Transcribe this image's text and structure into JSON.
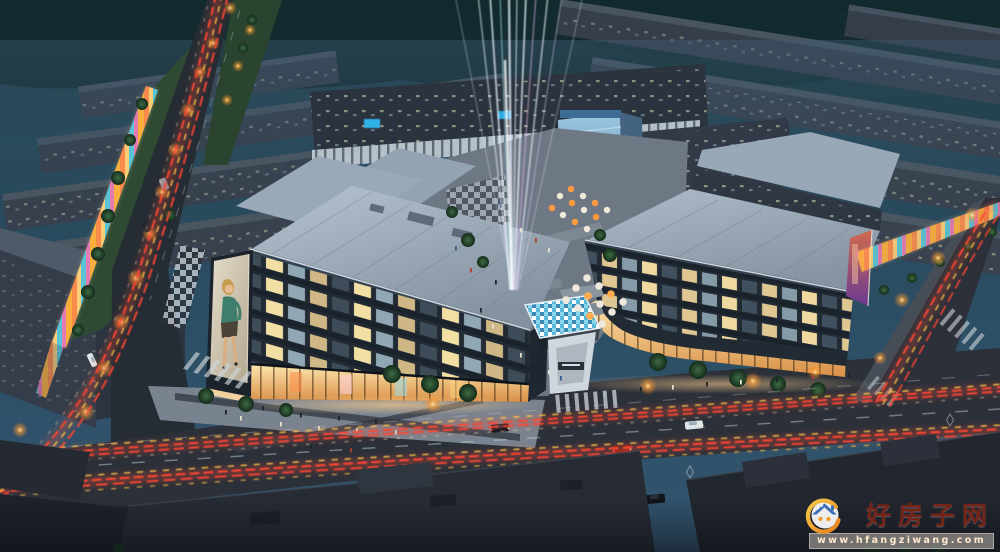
{
  "watermark": {
    "site_name": "好房子网",
    "site_url": "www.hfangziwang.com"
  },
  "scene": {
    "type": "architectural-rendering-aerial-night",
    "palette": {
      "sky": "#2b4c63",
      "background_buildings": "#39424e",
      "main_roof": "#a9b8c6",
      "window_glow": "#f0dca2",
      "retail_glow": "#ffc36b",
      "light_trail_red": "#ff4733",
      "light_trail_amber": "#ffc34a",
      "road": "#2c313a",
      "plaza": "#79828d",
      "tree": "#24402c",
      "canal": "#3f6d8c",
      "billboard": "#d9d0bd"
    }
  }
}
